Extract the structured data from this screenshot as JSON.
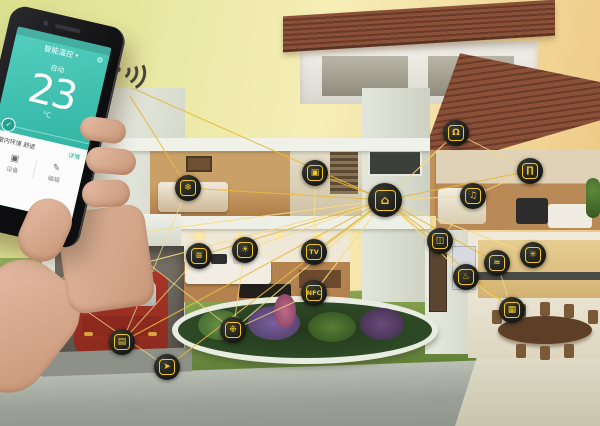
{
  "colors": {
    "accent_yellow": "#f3c623",
    "icon_bg": "#1b1c17",
    "link_line": "#e7ba3e",
    "link_line_light": "#f6dc85",
    "screen_teal_light": "#55cfc0",
    "screen_teal_dark": "#2fb3a2",
    "phone_black": "#141416",
    "sky_left": "#dbe08e",
    "sky_right": "#eec47f",
    "grass": "#7d9a47",
    "roof_tile": "#7c4631"
  },
  "phone": {
    "status": "",
    "title": "智能温控",
    "caret": "▾",
    "gear": "⚙",
    "mode": "自动",
    "temp": "23",
    "unit": "°C",
    "check": "✓",
    "row1_left": "室内环境 舒适",
    "row1_right": "详情",
    "menu": [
      {
        "glyph": "▣",
        "label": "设备"
      },
      {
        "glyph": "✎",
        "label": "编辑"
      }
    ]
  },
  "hub": {
    "name": "smart-home-gateway",
    "label": "gateway router",
    "glyph": "⌂",
    "x": 385,
    "y": 200
  },
  "devices": [
    {
      "name": "air-conditioner",
      "label": "air conditioner",
      "glyph": "❄",
      "x": 188,
      "y": 188
    },
    {
      "name": "security-camera",
      "label": "security camera",
      "glyph": "◉",
      "x": 113,
      "y": 236
    },
    {
      "name": "computer",
      "label": "computer",
      "glyph": "▣",
      "x": 315,
      "y": 173
    },
    {
      "name": "alarm-siren",
      "label": "alarm siren",
      "glyph": "Ω",
      "x": 456,
      "y": 133
    },
    {
      "name": "curtain-control",
      "label": "motorized curtains",
      "glyph": "∏",
      "x": 530,
      "y": 171
    },
    {
      "name": "audio-system",
      "label": "audio system",
      "glyph": "♫",
      "x": 473,
      "y": 196
    },
    {
      "name": "window-blinds",
      "label": "window blinds",
      "glyph": "≡",
      "x": 199,
      "y": 256
    },
    {
      "name": "smart-light",
      "label": "smart light",
      "glyph": "☀",
      "x": 245,
      "y": 250
    },
    {
      "name": "smart-tv",
      "label": "smart tv",
      "glyph": "TV",
      "x": 314,
      "y": 252,
      "text": true
    },
    {
      "name": "wifi-nfc",
      "label": "wifi nfc point",
      "glyph": "NFC",
      "x": 314,
      "y": 293,
      "text": true
    },
    {
      "name": "door-sensor",
      "label": "door sensor",
      "glyph": "◫",
      "x": 440,
      "y": 241
    },
    {
      "name": "stove",
      "label": "stove",
      "glyph": "♨",
      "x": 466,
      "y": 277
    },
    {
      "name": "water-valve",
      "label": "water valve",
      "glyph": "≈",
      "x": 497,
      "y": 263
    },
    {
      "name": "vent-fan",
      "label": "ventilation fan",
      "glyph": "✳",
      "x": 533,
      "y": 255
    },
    {
      "name": "oven",
      "label": "oven",
      "glyph": "▦",
      "x": 512,
      "y": 310
    },
    {
      "name": "smart-plug",
      "label": "smart plug",
      "glyph": "⚡",
      "x": 52,
      "y": 287
    },
    {
      "name": "garage-door",
      "label": "garage door",
      "glyph": "▤",
      "x": 122,
      "y": 342
    },
    {
      "name": "garden-sprinkler",
      "label": "garden sprinkler",
      "glyph": "❉",
      "x": 233,
      "y": 330
    },
    {
      "name": "motion-sensor",
      "label": "motion sensor",
      "glyph": "➤",
      "x": 167,
      "y": 367
    }
  ],
  "web_links": [
    [
      188,
      188,
      122,
      342
    ],
    [
      113,
      236,
      233,
      330
    ],
    [
      456,
      133,
      530,
      171
    ],
    [
      52,
      287,
      167,
      367
    ],
    [
      199,
      256,
      122,
      342
    ],
    [
      315,
      173,
      314,
      252
    ],
    [
      497,
      263,
      512,
      310
    ],
    [
      473,
      196,
      440,
      241
    ],
    [
      245,
      250,
      233,
      330
    ],
    [
      314,
      293,
      233,
      330
    ],
    [
      113,
      236,
      52,
      287
    ],
    [
      466,
      277,
      512,
      310
    ],
    [
      530,
      171,
      473,
      196
    ]
  ],
  "phone_links": [
    [
      132,
      88,
      385,
      200
    ],
    [
      130,
      96,
      188,
      188
    ]
  ]
}
